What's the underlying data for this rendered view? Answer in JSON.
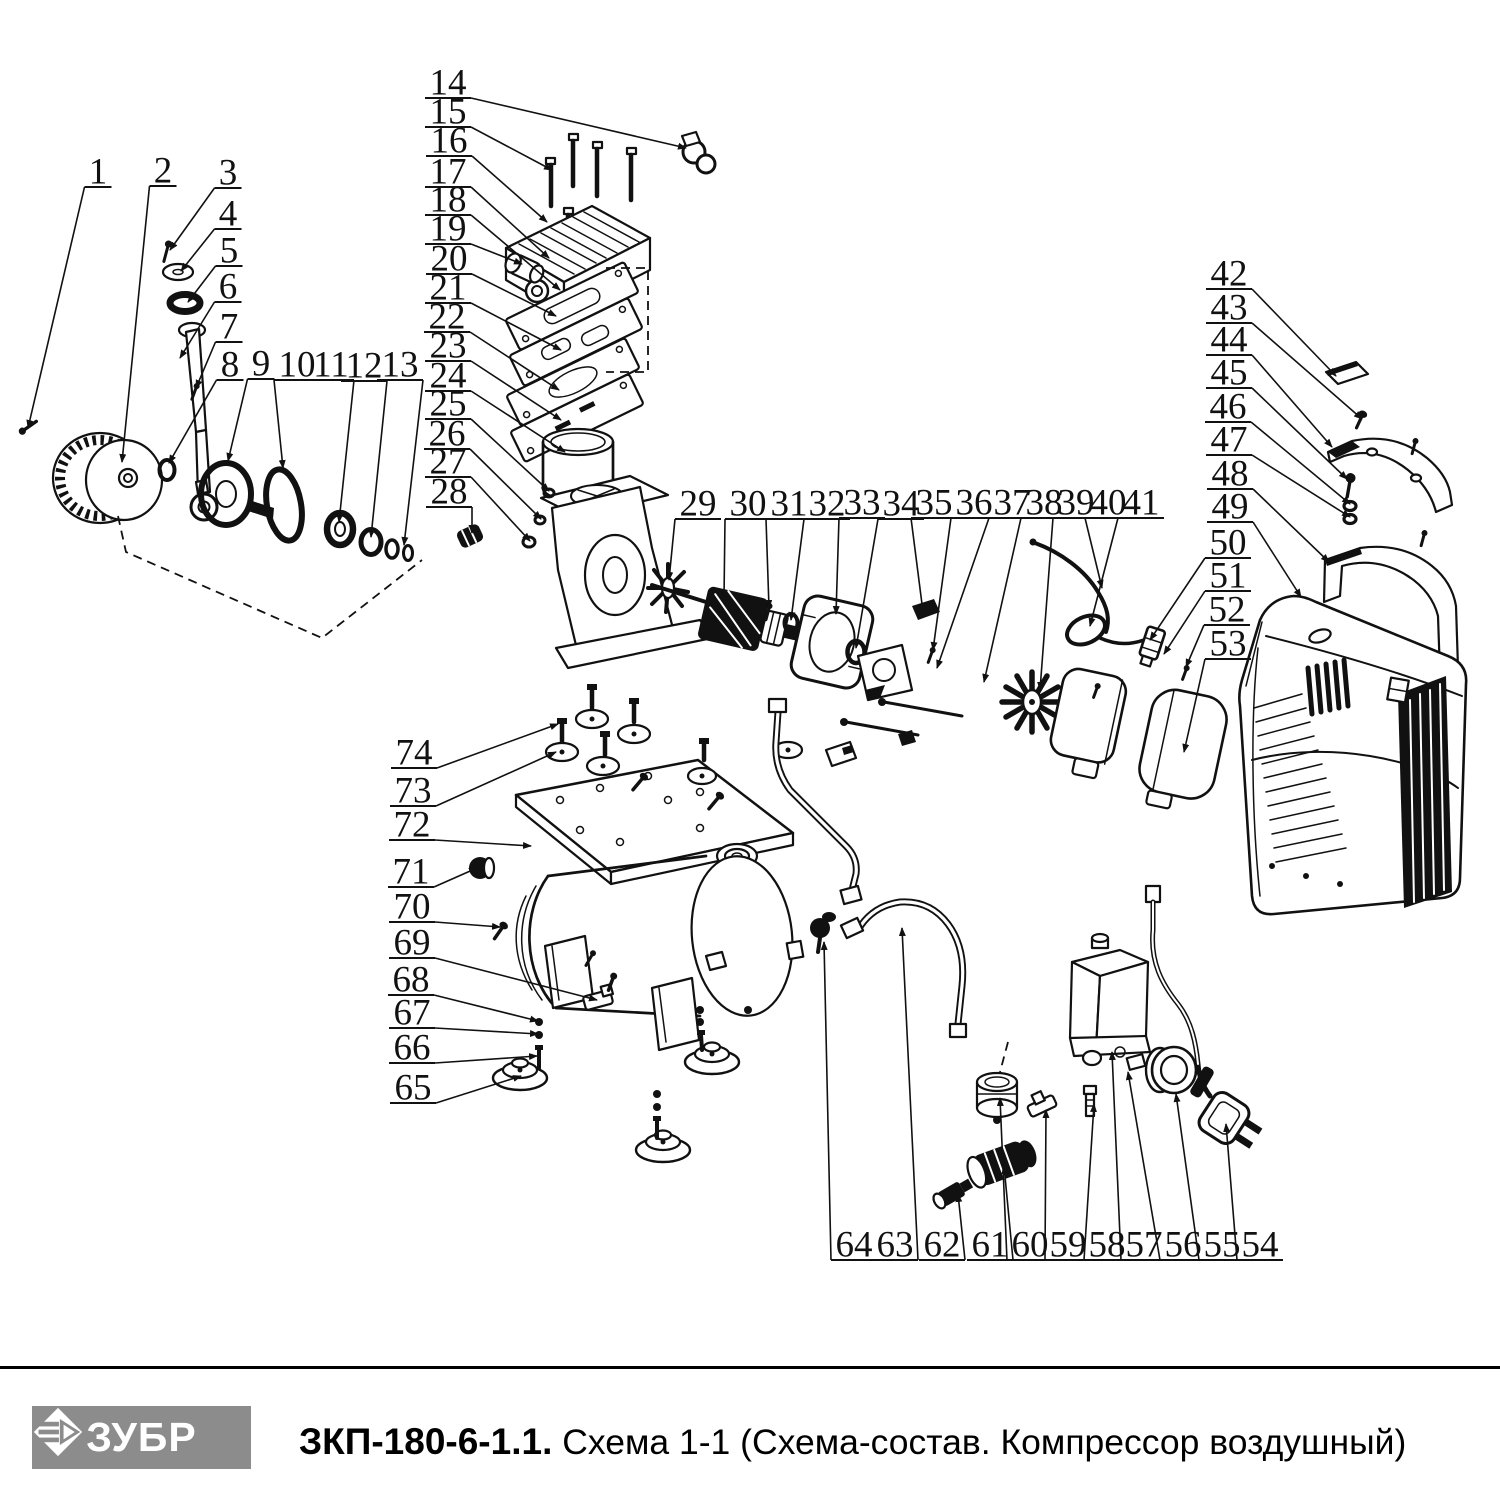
{
  "page": {
    "background": "#ffffff",
    "line_color": "#111111"
  },
  "footer": {
    "logo_text": "ЗУБР",
    "model": "ЗКП-180-6-1.1.",
    "subtitle": " Схема 1-1 (Схема-состав. Компрессор воздушный)",
    "bar_color": "#8c8c8c"
  },
  "callouts": [
    {
      "n": "1",
      "x": 98,
      "y": 172,
      "tx": 28,
      "ty": 428
    },
    {
      "n": "2",
      "x": 163,
      "y": 171,
      "tx": 122,
      "ty": 462
    },
    {
      "n": "3",
      "x": 228,
      "y": 173,
      "tx": 170,
      "ty": 250
    },
    {
      "n": "4",
      "x": 228,
      "y": 214,
      "tx": 181,
      "ty": 271
    },
    {
      "n": "5",
      "x": 229,
      "y": 251,
      "tx": 188,
      "ty": 302
    },
    {
      "n": "6",
      "x": 228,
      "y": 287,
      "tx": 180,
      "ty": 358
    },
    {
      "n": "7",
      "x": 229,
      "y": 327,
      "tx": 196,
      "ty": 388
    },
    {
      "n": "8",
      "x": 230,
      "y": 365,
      "tx": 169,
      "ty": 463
    },
    {
      "n": "9",
      "x": 261,
      "y": 364,
      "tx": 228,
      "ty": 461
    },
    {
      "n": "10",
      "x": 297,
      "y": 365,
      "tx": 283,
      "ty": 468
    },
    {
      "n": "11",
      "x": 331,
      "y": 365,
      "tx": 339,
      "ty": 522
    },
    {
      "n": "12",
      "x": 364,
      "y": 366,
      "tx": 371,
      "ty": 537
    },
    {
      "n": "13",
      "x": 400,
      "y": 365,
      "tx": 404,
      "ty": 545
    },
    {
      "n": "14",
      "x": 448,
      "y": 83,
      "tx": 686,
      "ty": 148
    },
    {
      "n": "15",
      "x": 448,
      "y": 112,
      "tx": 552,
      "ty": 170
    },
    {
      "n": "16",
      "x": 449,
      "y": 141,
      "tx": 547,
      "ty": 222
    },
    {
      "n": "17",
      "x": 448,
      "y": 172,
      "tx": 549,
      "ty": 258
    },
    {
      "n": "18",
      "x": 448,
      "y": 200,
      "tx": 560,
      "ty": 290
    },
    {
      "n": "19",
      "x": 448,
      "y": 229,
      "tx": 522,
      "ty": 264
    },
    {
      "n": "20",
      "x": 449,
      "y": 259,
      "tx": 556,
      "ty": 316
    },
    {
      "n": "21",
      "x": 448,
      "y": 288,
      "tx": 561,
      "ty": 350
    },
    {
      "n": "22",
      "x": 447,
      "y": 317,
      "tx": 559,
      "ty": 390
    },
    {
      "n": "23",
      "x": 448,
      "y": 346,
      "tx": 561,
      "ty": 420
    },
    {
      "n": "24",
      "x": 448,
      "y": 376,
      "tx": 565,
      "ty": 452
    },
    {
      "n": "25",
      "x": 448,
      "y": 404,
      "tx": 549,
      "ty": 491
    },
    {
      "n": "26",
      "x": 447,
      "y": 434,
      "tx": 541,
      "ty": 519
    },
    {
      "n": "27",
      "x": 448,
      "y": 462,
      "tx": 530,
      "ty": 541
    },
    {
      "n": "28",
      "x": 449,
      "y": 492,
      "tx": 472,
      "ty": 533
    },
    {
      "n": "29",
      "x": 698,
      "y": 504,
      "tx": 669,
      "ty": 580
    },
    {
      "n": "30",
      "x": 748,
      "y": 504,
      "tx": 724,
      "ty": 598
    },
    {
      "n": "31",
      "x": 789,
      "y": 504,
      "tx": 769,
      "ty": 608
    },
    {
      "n": "32",
      "x": 827,
      "y": 504,
      "tx": 791,
      "ty": 620
    },
    {
      "n": "33",
      "x": 862,
      "y": 503,
      "tx": 836,
      "ty": 614
    },
    {
      "n": "34",
      "x": 901,
      "y": 504,
      "tx": 856,
      "ty": 648
    },
    {
      "n": "35",
      "x": 934,
      "y": 503,
      "tx": 923,
      "ty": 612
    },
    {
      "n": "36",
      "x": 974,
      "y": 503,
      "tx": 933,
      "ty": 650
    },
    {
      "n": "37",
      "x": 1012,
      "y": 503,
      "tx": 937,
      "ty": 668
    },
    {
      "n": "38",
      "x": 1044,
      "y": 503,
      "tx": 984,
      "ty": 682
    },
    {
      "n": "39",
      "x": 1076,
      "y": 503,
      "tx": 1040,
      "ty": 690
    },
    {
      "n": "40",
      "x": 1108,
      "y": 503,
      "tx": 1102,
      "ty": 588
    },
    {
      "n": "41",
      "x": 1141,
      "y": 503,
      "tx": 1090,
      "ty": 626
    },
    {
      "n": "42",
      "x": 1229,
      "y": 274,
      "tx": 1336,
      "ty": 376
    },
    {
      "n": "43",
      "x": 1229,
      "y": 308,
      "tx": 1362,
      "ty": 419
    },
    {
      "n": "44",
      "x": 1229,
      "y": 340,
      "tx": 1332,
      "ty": 447
    },
    {
      "n": "45",
      "x": 1229,
      "y": 373,
      "tx": 1347,
      "ty": 479
    },
    {
      "n": "46",
      "x": 1228,
      "y": 407,
      "tx": 1350,
      "ty": 504
    },
    {
      "n": "47",
      "x": 1229,
      "y": 440,
      "tx": 1350,
      "ty": 517
    },
    {
      "n": "48",
      "x": 1230,
      "y": 474,
      "tx": 1329,
      "ty": 562
    },
    {
      "n": "49",
      "x": 1230,
      "y": 507,
      "tx": 1301,
      "ty": 597
    },
    {
      "n": "50",
      "x": 1228,
      "y": 543,
      "tx": 1150,
      "ty": 640
    },
    {
      "n": "51",
      "x": 1228,
      "y": 576,
      "tx": 1164,
      "ty": 654
    },
    {
      "n": "52",
      "x": 1227,
      "y": 610,
      "tx": 1186,
      "ty": 667
    },
    {
      "n": "53",
      "x": 1228,
      "y": 644,
      "tx": 1184,
      "ty": 752
    },
    {
      "n": "54",
      "x": 1260,
      "y": 1245,
      "tx": 1226,
      "ty": 1124
    },
    {
      "n": "55",
      "x": 1222,
      "y": 1245,
      "tx": 1176,
      "ty": 1094
    },
    {
      "n": "56",
      "x": 1183,
      "y": 1245,
      "tx": 1128,
      "ty": 1072
    },
    {
      "n": "57",
      "x": 1144,
      "y": 1245,
      "tx": 1112,
      "ty": 1052
    },
    {
      "n": "58",
      "x": 1107,
      "y": 1245,
      "tx": 1094,
      "ty": 1104
    },
    {
      "n": "59",
      "x": 1068,
      "y": 1245,
      "tx": 1046,
      "ty": 1110
    },
    {
      "n": "60",
      "x": 1030,
      "y": 1245,
      "tx": 1000,
      "ty": 1098
    },
    {
      "n": "61",
      "x": 990,
      "y": 1245,
      "tx": 1004,
      "ty": 1166
    },
    {
      "n": "62",
      "x": 942,
      "y": 1245,
      "tx": 958,
      "ty": 1194
    },
    {
      "n": "63",
      "x": 895,
      "y": 1245,
      "tx": 902,
      "ty": 928
    },
    {
      "n": "64",
      "x": 854,
      "y": 1245,
      "tx": 824,
      "ty": 942
    },
    {
      "n": "65",
      "x": 413,
      "y": 1088,
      "tx": 521,
      "ty": 1076
    },
    {
      "n": "66",
      "x": 412,
      "y": 1048,
      "tx": 537,
      "ty": 1056
    },
    {
      "n": "67",
      "x": 412,
      "y": 1013,
      "tx": 538,
      "ty": 1034
    },
    {
      "n": "68",
      "x": 411,
      "y": 980,
      "tx": 538,
      "ty": 1021
    },
    {
      "n": "69",
      "x": 412,
      "y": 943,
      "tx": 597,
      "ty": 1000
    },
    {
      "n": "70",
      "x": 412,
      "y": 907,
      "tx": 500,
      "ty": 927
    },
    {
      "n": "71",
      "x": 411,
      "y": 872,
      "tx": 477,
      "ty": 868
    },
    {
      "n": "72",
      "x": 412,
      "y": 825,
      "tx": 531,
      "ty": 846
    },
    {
      "n": "73",
      "x": 413,
      "y": 791,
      "tx": 556,
      "ty": 752
    },
    {
      "n": "74",
      "x": 414,
      "y": 753,
      "tx": 558,
      "ty": 724
    }
  ]
}
